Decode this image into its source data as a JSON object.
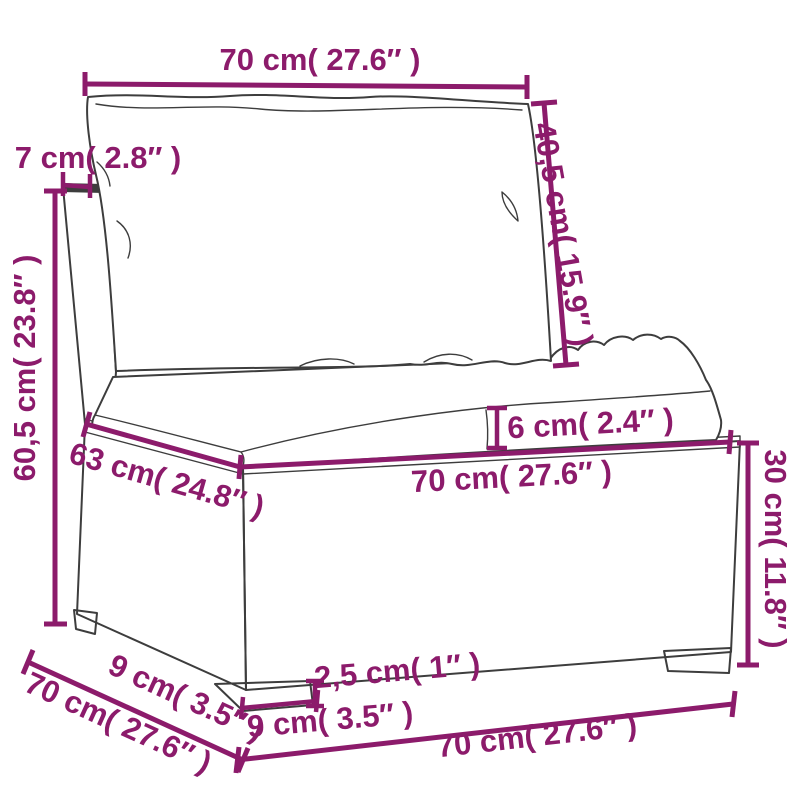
{
  "figure": {
    "type": "product-dimension-diagram",
    "subject": "poly-rattan garden sofa middle section with back cushion and seat cushion"
  },
  "colors": {
    "dimension_accent": "#8C1B6B",
    "sketch_outline": "#3D3D3D",
    "background": "#FFFFFF"
  },
  "dimensions": {
    "back_cushion_width": "70 cm( 27.6″ )",
    "back_cushion_height": "40,5 cm( 15.9″ )",
    "back_frame_thickness": "7 cm( 2.8″ )",
    "backrest_height": "60,5 cm( 23.8″ )",
    "seat_depth": "63 cm( 24.8″ )",
    "seat_cushion_thickness": "6 cm( 2.4″ )",
    "seat_width": "70 cm( 27.6″ )",
    "base_height": "30 cm( 11.8″ )",
    "leg_height": "2,5 cm( 1″ )",
    "leg_width": "9 cm( 3.5″ )",
    "leg_depth": "9 cm( 3.5″ )",
    "overall_depth": "70 cm( 27.6″ )",
    "overall_width": "70 cm( 27.6″ )"
  }
}
